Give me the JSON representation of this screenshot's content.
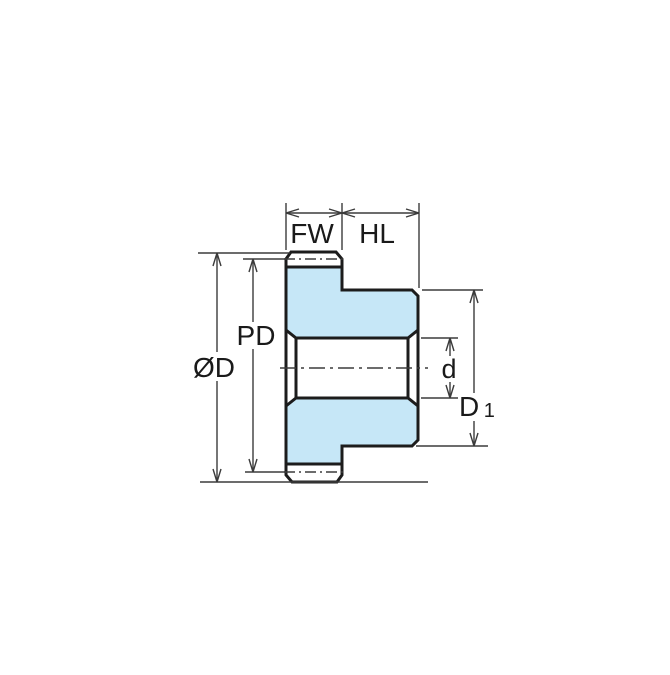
{
  "diagram": {
    "type": "engineering-drawing",
    "subject": "spur-gear-cross-section",
    "labels": {
      "face_width": "FW",
      "hub_length": "HL",
      "pitch_diameter": "PD",
      "outer_diameter": "ØD",
      "bore_diameter": "d",
      "hub_diameter_main": "D",
      "hub_diameter_sub": "1"
    },
    "colors": {
      "part_fill": "#c6e7f7",
      "part_outline": "#1c1c1c",
      "dimension_lines": "#3b3b3b",
      "background": "#ffffff"
    }
  }
}
